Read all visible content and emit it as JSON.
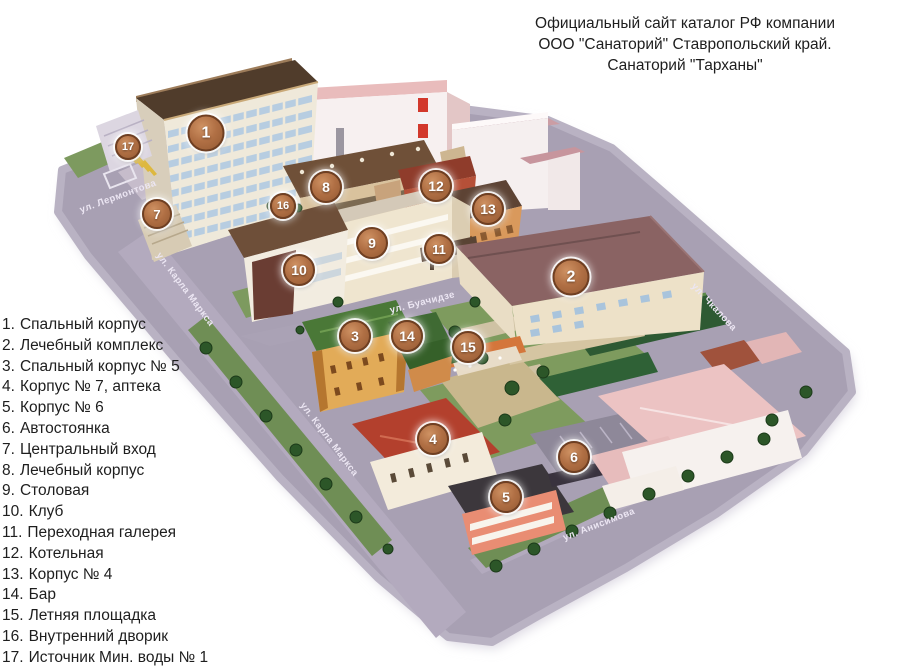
{
  "title": {
    "lines": [
      "Официальный сайт каталог РФ компании",
      "ООО \"Санаторий\" Ставропольский край.",
      "Санаторий \"Тарханы\""
    ]
  },
  "legend": {
    "items": [
      {
        "num": "1.",
        "label": "Спальный корпус"
      },
      {
        "num": "2.",
        "label": "Лечебный комплекс"
      },
      {
        "num": "3.",
        "label": "Спальный корпус № 5"
      },
      {
        "num": "4.",
        "label": "Корпус № 7, аптека"
      },
      {
        "num": "5.",
        "label": "Корпус № 6"
      },
      {
        "num": "6.",
        "label": "Автостоянка"
      },
      {
        "num": "7.",
        "label": "Центральный вход"
      },
      {
        "num": "8.",
        "label": "Лечебный корпус"
      },
      {
        "num": "9.",
        "label": "Столовая"
      },
      {
        "num": "10.",
        "label": "Клуб"
      },
      {
        "num": "11.",
        "label": "Переходная галерея"
      },
      {
        "num": "12.",
        "label": "Котельная"
      },
      {
        "num": "13.",
        "label": "Корпус № 4"
      },
      {
        "num": "14.",
        "label": "Бар"
      },
      {
        "num": "15.",
        "label": "Летняя площадка"
      },
      {
        "num": "16.",
        "label": "Внутренний дворик"
      },
      {
        "num": "17.",
        "label": "Источник Мин. воды № 1"
      }
    ]
  },
  "map": {
    "street_labels": [
      "ул. Лермонтова",
      "ул. Карла Маркса",
      "ул. Карла Маркса",
      "ул. Буачидзе",
      "ул. Чкалова",
      "ул. Анисимова"
    ],
    "markers": [
      "1",
      "2",
      "3",
      "4",
      "5",
      "6",
      "7",
      "8",
      "9",
      "10",
      "11",
      "12",
      "13",
      "14",
      "15",
      "16",
      "17"
    ],
    "colors": {
      "marker_fill": "#a96a40",
      "marker_border": "#6f3f22",
      "street": "#a8a0b3",
      "grass": "#7d9a5f",
      "hedge": "#2e5a33",
      "roof_brown": "#4f3b2c",
      "roof_mauve": "#8a6363",
      "roof_pink": "#ecc3c3",
      "roof_green": "#4a7837",
      "roof_red": "#b3402d",
      "chimney_red": "#d2382c"
    }
  }
}
